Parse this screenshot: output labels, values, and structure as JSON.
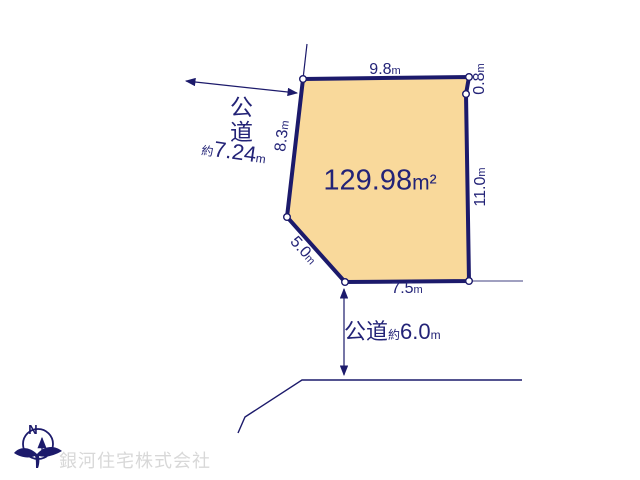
{
  "colors": {
    "line": "#1C1A6B",
    "text": "#232377",
    "parcel_fill": "#F9D99B",
    "extension_line": "#8080AC",
    "watermark_text": "#D8D8D8"
  },
  "parcel": {
    "area": {
      "value": "129.98",
      "unit": "m²"
    },
    "edges": {
      "top": {
        "value": "9.8",
        "unit": "m"
      },
      "top_right": {
        "value": "0.8",
        "unit": "m"
      },
      "right": {
        "value": "11.0",
        "unit": "m"
      },
      "bottom": {
        "value": "7.5",
        "unit": "m"
      },
      "diagonal_sw": {
        "value": "5.0",
        "unit": "m"
      },
      "left": {
        "value": "8.3",
        "unit": "m"
      }
    }
  },
  "roads": {
    "west": {
      "label": "公道",
      "approx_prefix": "約",
      "width_value": "7.24",
      "width_unit": "m"
    },
    "south": {
      "label": "公道",
      "approx_prefix": "約",
      "width_value": "6.0",
      "width_unit": "m"
    }
  },
  "compass": {
    "north_label": "N"
  },
  "footer": {
    "company_watermark": "銀河住宅株式会社"
  }
}
